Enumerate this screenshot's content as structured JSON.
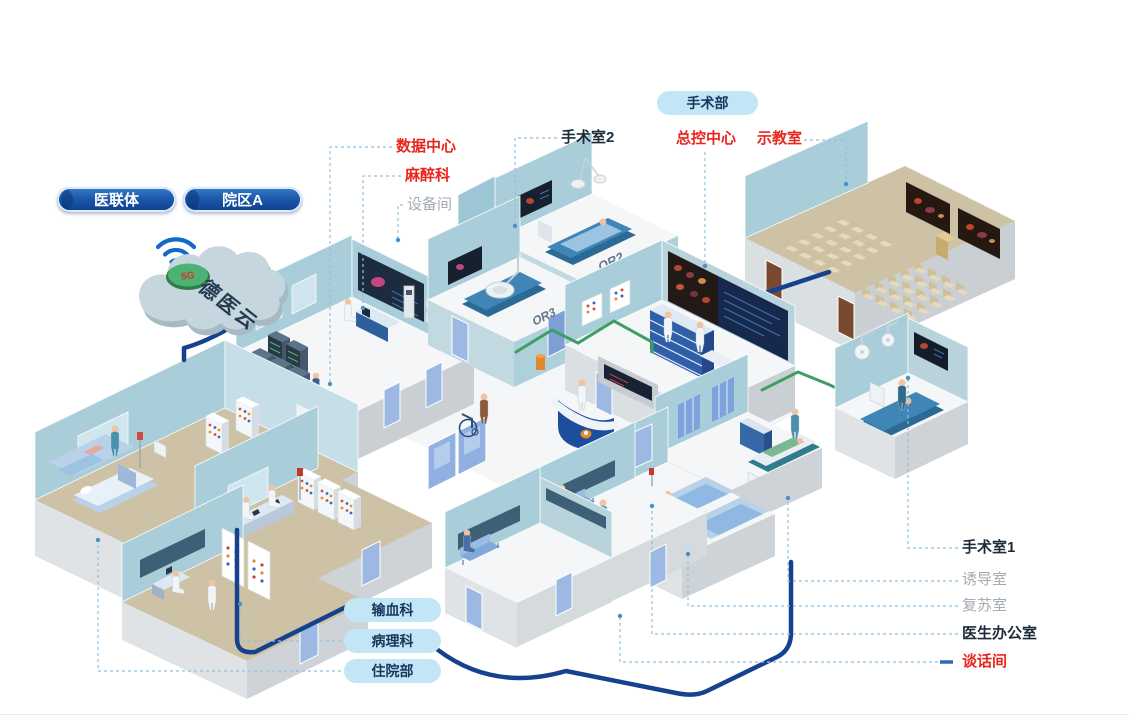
{
  "colors": {
    "accent_red": "#e8261d",
    "label_dark": "#1c2b3a",
    "label_gray": "#a3abb3",
    "pill_dark": "#0b3e8c",
    "pill_light": "#c3e6f6",
    "cable_blue": "#16418f",
    "cable_green": "#3f9e63",
    "wall_teal": "#a9ced9",
    "floor_tan": "#cec2a6",
    "wifi_blue": "#1169c9"
  },
  "cloud": {
    "name": "德医云",
    "badge": "5G"
  },
  "org_pills": [
    {
      "label": "医联体"
    },
    {
      "label": "院区A"
    }
  ],
  "area_pill": {
    "label": "手术部"
  },
  "dept_pills": [
    {
      "label": "输血科"
    },
    {
      "label": "病理科"
    },
    {
      "label": "住院部"
    }
  ],
  "room_labels": [
    {
      "id": "data-center",
      "label": "数据中心",
      "style": "red"
    },
    {
      "id": "anesthesia",
      "label": "麻醉科",
      "style": "red"
    },
    {
      "id": "equipment-room",
      "label": "设备间",
      "style": "gray"
    },
    {
      "id": "or-2",
      "label": "手术室2",
      "style": "dark"
    },
    {
      "id": "master-control",
      "label": "总控中心",
      "style": "red"
    },
    {
      "id": "demo-classroom",
      "label": "示教室",
      "style": "red"
    },
    {
      "id": "or-1",
      "label": "手术室1",
      "style": "dark"
    },
    {
      "id": "induction-room",
      "label": "诱导室",
      "style": "gray"
    },
    {
      "id": "recovery-room",
      "label": "复苏室",
      "style": "gray"
    },
    {
      "id": "doctor-office",
      "label": "医生办公室",
      "style": "dark"
    },
    {
      "id": "talk-room",
      "label": "谈话间",
      "style": "red"
    }
  ],
  "wall_marks": {
    "or2": "OR2",
    "or3": "OR3"
  }
}
